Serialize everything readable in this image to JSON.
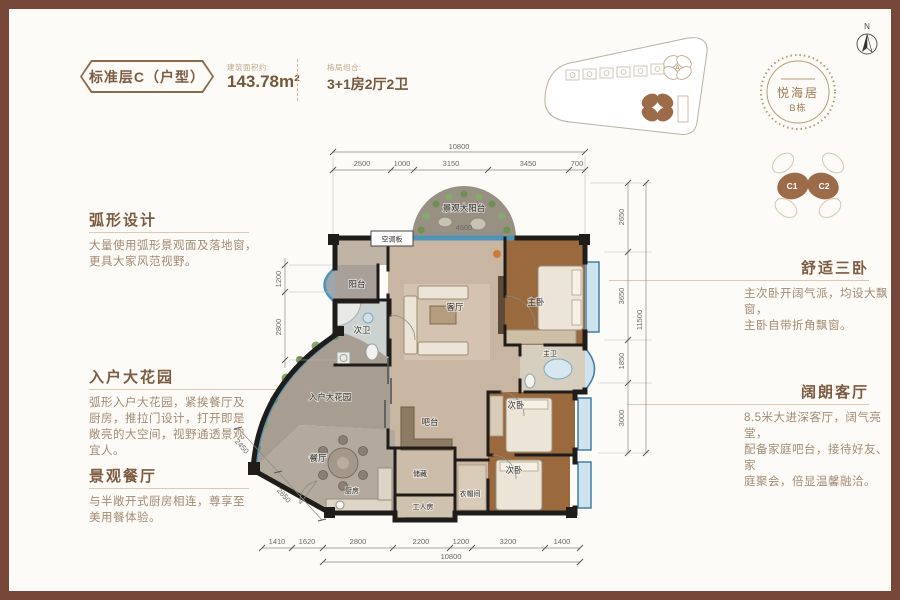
{
  "header": {
    "badge": "标准层C（户型）",
    "area_label": "建筑面积约:",
    "area_value": "143.78m²",
    "layout_label": "格局组合:",
    "layout_value": "3+1房2厅2卫"
  },
  "left_sections": [
    {
      "title": "弧形设计",
      "lines": [
        "大量使用弧形景观面及落地窗，",
        "更具大家风范视野。"
      ]
    },
    {
      "title": "入户大花园",
      "lines": [
        "弧形入户大花园，紧挨餐厅及",
        "厨房，推拉门设计，打开即是",
        "敞亮的大空间，视野通透景观",
        "宜人。"
      ]
    },
    {
      "title": "景观餐厅",
      "lines": [
        "与半敞开式厨房相连，尊享至",
        "美用餐体验。"
      ]
    }
  ],
  "right_sections": [
    {
      "title": "舒适三卧",
      "lines": [
        "主次卧开阔气派，均设大飘窗，",
        "主卧自带折角飘窗。"
      ]
    },
    {
      "title": "阔朗客厅",
      "lines": [
        "8.5米大进深客厅，阔气亮堂，",
        "配备家庭吧台，接待好友、家",
        "庭聚会，倍显温馨融洽。"
      ]
    }
  ],
  "logo": {
    "name": "悦海居",
    "building": "B栋"
  },
  "unit_badges": {
    "c1": "C1",
    "c2": "C2"
  },
  "site_plan": {
    "tower_a": "A",
    "tower_b": "B"
  },
  "compass_label": "N",
  "floor_plan": {
    "rooms": {
      "balcony_top": "景观大阳台",
      "balcony_left": "阳台",
      "bath2": "次卫",
      "living": "客厅",
      "master": "主卧",
      "master_bath": "主卫",
      "bed2": "次卧",
      "bed3": "次卧",
      "bar": "吧台",
      "garden": "入户大花园",
      "dining": "餐厅",
      "kitchen": "厨房",
      "storage": "储藏",
      "maid": "工人房",
      "cloak": "衣帽间",
      "ac": "空调板"
    },
    "dims": {
      "top_total": "10800",
      "top_segments": [
        "2500",
        "1000",
        "3150",
        "3450",
        "700"
      ],
      "bottom_segments": [
        "1410",
        "1620",
        "2800",
        "2200",
        "1200",
        "3200",
        "1400"
      ],
      "bottom_total": "10800",
      "right_segments": [
        "2650",
        "3650",
        "1850",
        "3000"
      ],
      "right_total": "11500",
      "left_segments": [
        "1200",
        "2800"
      ],
      "left_slant": [
        "2450",
        "2650"
      ],
      "balcony_width": "4600"
    }
  }
}
